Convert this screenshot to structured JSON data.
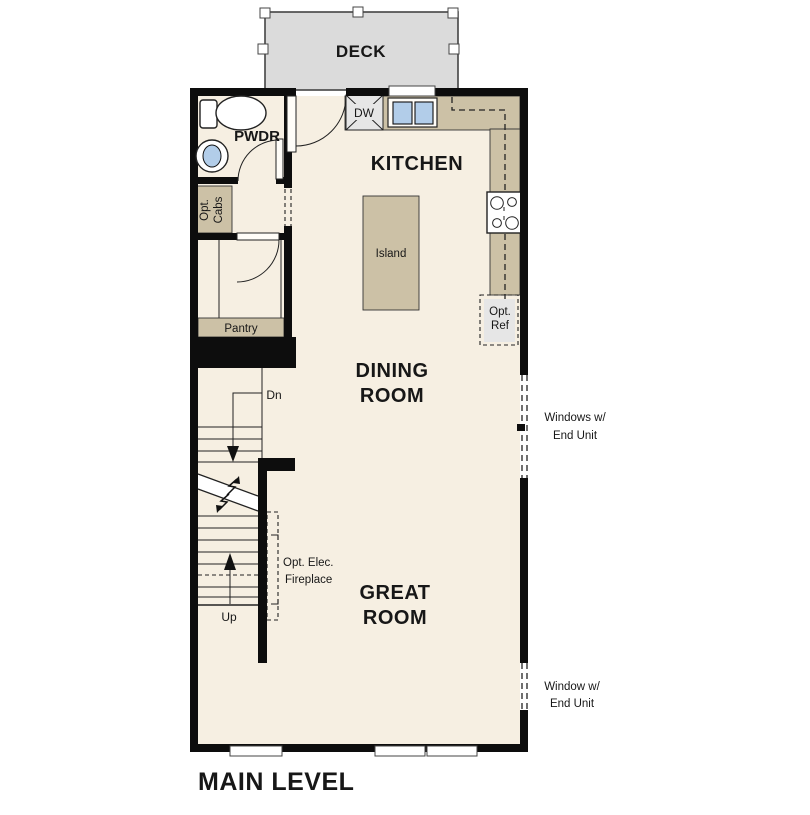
{
  "title": "MAIN LEVEL",
  "deck": {
    "label": "DECK"
  },
  "rooms": {
    "kitchen": "KITCHEN",
    "dining": [
      "DINING",
      "ROOM"
    ],
    "great": [
      "GREAT",
      "ROOM"
    ],
    "pwdr": "PWDR",
    "pantry": "Pantry",
    "island": "Island"
  },
  "fixtures": {
    "dishwasher": "DW",
    "opt_ref": [
      "Opt.",
      "Ref"
    ],
    "opt_cabs": [
      "Opt.",
      "Cabs"
    ],
    "fireplace": [
      "Opt. Elec.",
      "Fireplace"
    ]
  },
  "stairs": {
    "down": "Dn",
    "up": "Up"
  },
  "annotations": {
    "windows_upper": [
      "Windows w/",
      "End Unit"
    ],
    "window_lower": [
      "Window w/",
      "End Unit"
    ]
  },
  "colors": {
    "floor": "#f6efe2",
    "counter": "#ccc1a6",
    "deck": "#dbdbdb",
    "appliance": "#e6e6e6",
    "sink": "#b2cde9",
    "wall": "#0d0d0d"
  }
}
